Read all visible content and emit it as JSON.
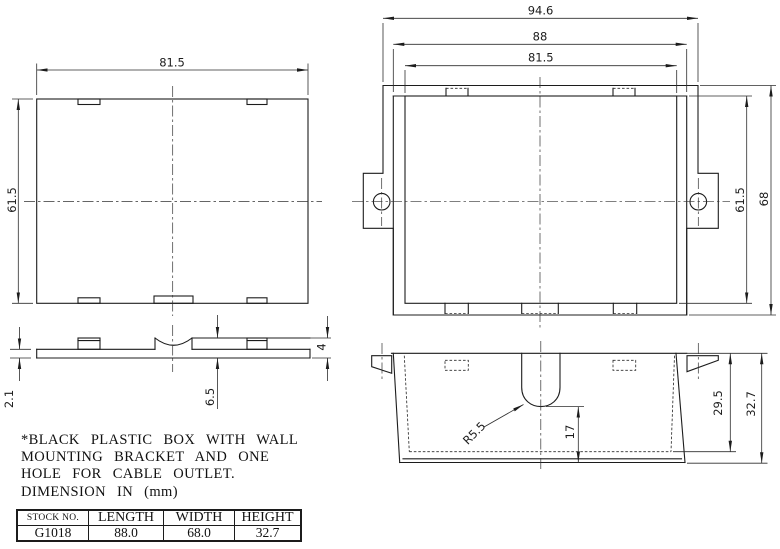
{
  "drawing": {
    "note_lines": [
      "*BLACK PLASTIC BOX WITH WALL",
      "MOUNTING BRACKET AND ONE",
      "HOLE FOR CABLE OUTLET.",
      "DIMENSION IN (mm)"
    ],
    "spec_table": {
      "headers": [
        "STOCK NO.",
        "LENGTH",
        "WIDTH",
        "HEIGHT"
      ],
      "rows": [
        [
          "G1018",
          "88.0",
          "68.0",
          "32.7"
        ]
      ]
    },
    "views": {
      "box_plan": {
        "width": "81.5",
        "height": "61.5"
      },
      "bracket_plan": {
        "overall_width": "94.6",
        "plate_width": "88",
        "box_width": "81.5",
        "box_height": "61.5",
        "plate_height": "68"
      },
      "bracket_side": {
        "plate_thickness": "2.1",
        "tab_height": "6.5",
        "boss_height": "4"
      },
      "box_front": {
        "corner_radius": "R5.5",
        "outlet_depth": "17",
        "inner_depth": "29.5",
        "overall_height": "32.7"
      }
    },
    "colors": {
      "line": "#1c1c1c",
      "background": "#ffffff"
    }
  }
}
